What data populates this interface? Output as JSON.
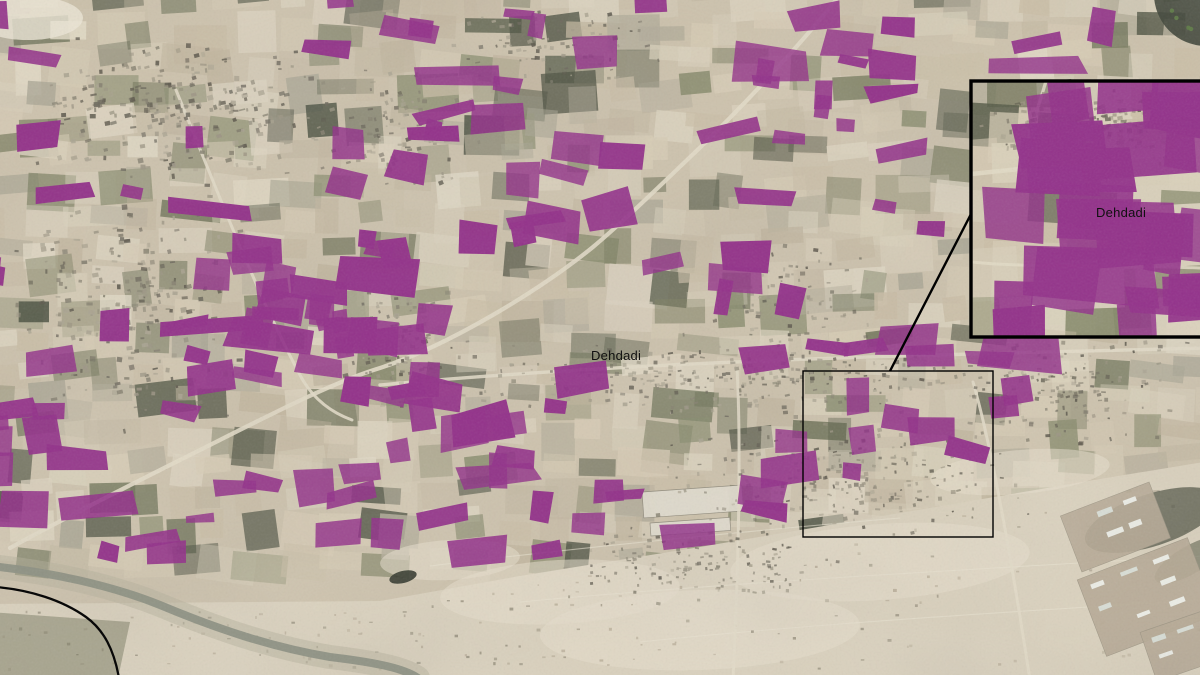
{
  "figure": {
    "type": "satellite-map",
    "width": 1200,
    "height": 675
  },
  "map": {
    "labels": {
      "main": "Dehdadi",
      "inset": "Dehdadi"
    },
    "label_positions": {
      "main": {
        "x": 591,
        "y": 360
      },
      "inset": {
        "x": 1096,
        "y": 217
      }
    },
    "overlay_color": "#93338a",
    "base_color": "#cdc2ac",
    "desert_color": "#dad1bd",
    "road_color": "#e2dac6",
    "river_color": "#8e9184",
    "annotation_color": "#000000"
  },
  "annotation": {
    "extent_rect": {
      "x": 803,
      "y": 371,
      "width": 190,
      "height": 166
    },
    "inset_rect": {
      "x": 971,
      "y": 81,
      "width": 231,
      "height": 256
    },
    "leader_line": {
      "x1": 890,
      "y1": 371,
      "x2": 971,
      "y2": 214
    }
  },
  "generation": {
    "seed": 1337,
    "purple_count": 195,
    "inset_purple_count": 27,
    "field_palette": {
      "tan": [
        "#d7ccb5",
        "#cabea6",
        "#c1b59e",
        "#dcd3bf"
      ],
      "olive": [
        "#7b7e60",
        "#6b7055",
        "#868a6b"
      ],
      "dark": [
        "#575c49",
        "#484d3d"
      ],
      "light": [
        "#e2dac6",
        "#d9d1bb"
      ],
      "gray": [
        "#a8a492",
        "#b3ad9a"
      ]
    },
    "roads": [
      {
        "d": "M 836,0 C 800,45 740,110 687,160 C 640,205 618,226 593,247 C 540,290 450,345 380,368 C 330,383 260,420 190,455 C 140,480 70,515 10,548",
        "w": 4.2
      },
      {
        "d": "M 380,385 C 520,372 700,362 900,356 C 1000,353 1120,350 1205,348",
        "w": 3.4
      },
      {
        "d": "M 737,368 C 741,440 739,560 733,680",
        "w": 3
      },
      {
        "d": "M 973,382 C 990,440 1010,550 1030,680",
        "w": 3
      },
      {
        "d": "M 176,90 C 215,185 255,290 300,375 C 312,398 330,412 352,420",
        "w": 3
      }
    ],
    "inset_roads": [
      {
        "d": "M 971,174 C 1040,167 1130,157 1200,151",
        "w": 4.5
      },
      {
        "d": "M 1046,81 C 1036,115 1024,150 1018,174",
        "w": 3.2
      },
      {
        "d": "M 971,262 C 1030,268 1100,264 1200,268",
        "w": 3
      }
    ],
    "urban_zones": [
      {
        "x": 25,
        "y": 35,
        "w": 300,
        "h": 150,
        "rot": -8,
        "n": 270,
        "s": 1
      },
      {
        "x": 0,
        "y": 180,
        "w": 250,
        "h": 250,
        "rot": -4,
        "n": 260,
        "s": 1
      },
      {
        "x": 300,
        "y": 60,
        "w": 190,
        "h": 130,
        "rot": -10,
        "n": 110,
        "s": 0.85
      },
      {
        "x": 330,
        "y": 280,
        "w": 130,
        "h": 130,
        "rot": -6,
        "n": 120,
        "s": 0.85
      },
      {
        "x": 430,
        "y": 330,
        "w": 610,
        "h": 90,
        "rot": -2,
        "n": 300,
        "s": 0.8
      },
      {
        "x": 640,
        "y": 418,
        "w": 400,
        "h": 120,
        "rot": -3,
        "n": 240,
        "s": 0.8
      },
      {
        "x": 950,
        "y": 330,
        "w": 240,
        "h": 115,
        "rot": -4,
        "n": 150,
        "s": 0.8
      },
      {
        "x": 540,
        "y": 518,
        "w": 310,
        "h": 90,
        "rot": -1,
        "n": 150,
        "s": 0.7,
        "force": true
      },
      {
        "x": 450,
        "y": 0,
        "w": 220,
        "h": 90,
        "rot": -6,
        "n": 80,
        "s": 0.8
      },
      {
        "x": 700,
        "y": 240,
        "w": 180,
        "h": 110,
        "rot": -4,
        "n": 90,
        "s": 0.8
      }
    ],
    "desert": {
      "outline": "M -10,604 L 380,601 L 520,576 L 700,547 L 900,513 L 1100,479 L 1210,461 L 1210,685 L -10,685 Z",
      "patches": [
        [
          560,
          592,
          120,
          32,
          -3
        ],
        [
          880,
          562,
          150,
          38,
          -4
        ],
        [
          1020,
          472,
          90,
          22,
          -5
        ],
        [
          450,
          560,
          70,
          20,
          -3
        ],
        [
          700,
          630,
          160,
          40,
          -2
        ]
      ],
      "tracks": [
        "M 430,566 C 600,545 760,530 900,518",
        "M 520,602 C 700,585 950,570 1205,556",
        "M 640,642 C 800,625 1000,612 1205,600"
      ],
      "warehouses": [
        [
          642,
          492,
          100,
          26,
          -4
        ],
        [
          650,
          523,
          80,
          13,
          -4
        ]
      ],
      "pads": [
        {
          "x": 1068,
          "y": 497,
          "w": 95,
          "h": 60,
          "rot": -21
        },
        {
          "x": 1088,
          "y": 556,
          "w": 118,
          "h": 82,
          "rot": -21
        },
        {
          "x": 1146,
          "y": 616,
          "w": 92,
          "h": 52,
          "rot": -19
        }
      ]
    },
    "river": "M -10,566 C 50,572 110,585 160,605 C 215,628 270,647 330,657 C 380,663 405,669 418,678",
    "black_curve": "M -4,587 C 30,590 62,600 86,617 C 104,630 114,650 119,678"
  }
}
